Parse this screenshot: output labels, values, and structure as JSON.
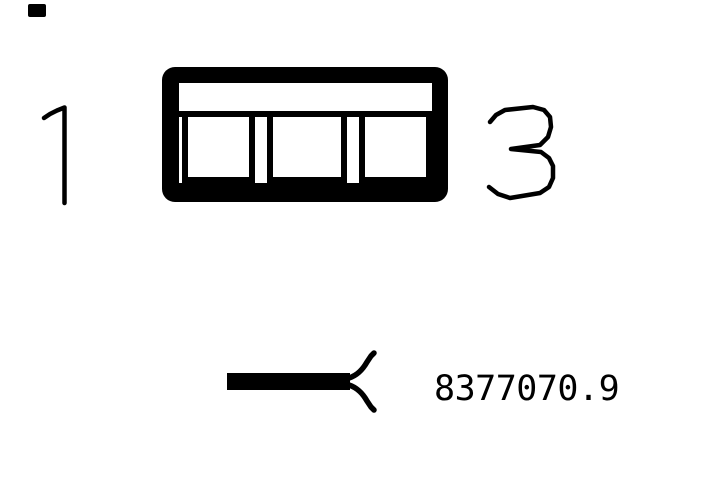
{
  "diagram": {
    "background_color": "#ffffff",
    "ink_color": "#000000",
    "connector": {
      "cavity_count": 3,
      "pin_label_left": "1",
      "pin_label_right": "3"
    },
    "legend": {
      "symbol": "wire-with-terminal-symbol",
      "part_number": "8377070.9"
    }
  }
}
